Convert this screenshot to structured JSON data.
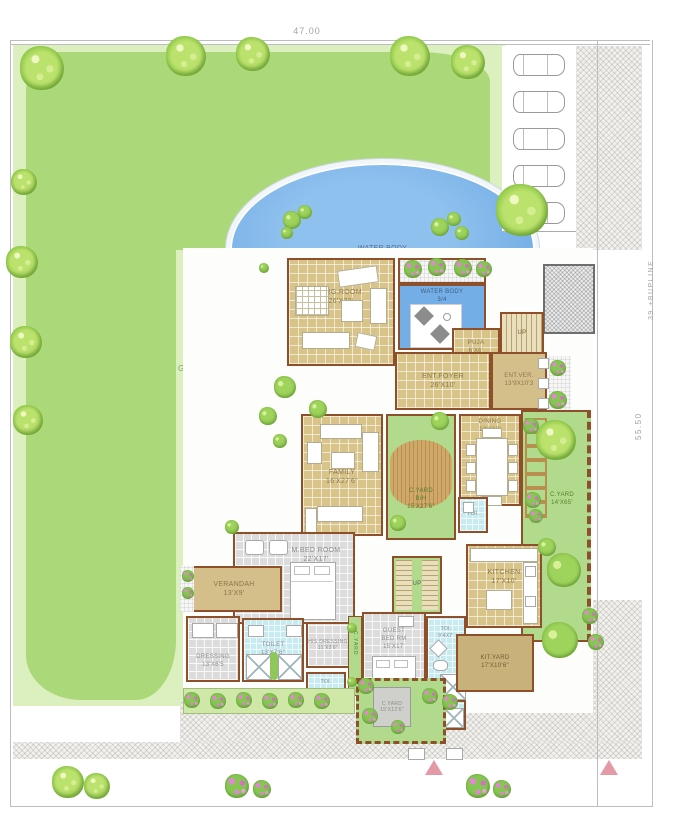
{
  "title": "residential site / floor plan",
  "dimensions": {
    "plot_width": "47.00",
    "build_line": "39 +BUPLINE",
    "plot_depth": "55.50"
  },
  "garden": {
    "label": "GARDEN"
  },
  "pool": {
    "label": "WATER BODY"
  },
  "rooms": {
    "drg_room": {
      "name": "DRG.ROOM",
      "size": "26'X23'"
    },
    "water_body_sm": {
      "name": "WATER BODY",
      "size": "3/4"
    },
    "puja": {
      "name": "PUJA",
      "size": "6'X6'"
    },
    "ent_foyer": {
      "name": "ENT.FOYER",
      "size": "26'X10'"
    },
    "ent_ver": {
      "name": "ENT.VER.",
      "size": "13'9X10'3"
    },
    "family": {
      "name": "FAMILY",
      "size": "16'X27'6\""
    },
    "cyard_bh": {
      "name": "C.YARD",
      "mid": "B/H",
      "size": "15'X27'6\""
    },
    "dining": {
      "name": "DINING",
      "size": "12'X18'"
    },
    "cyard_right": {
      "name": "C.YARD",
      "size": "14'X65'"
    },
    "mbed": {
      "name": "M.BED ROOM",
      "size": "22'X17'"
    },
    "verandah": {
      "name": "VERANDAH",
      "size": "13'X9'"
    },
    "dressing": {
      "name": "DRESSING",
      "size": "13'X6'5"
    },
    "toilet": {
      "name": "TOILET",
      "size": "13'X7'6\""
    },
    "his_dressing": {
      "name": "HIS DRESSING",
      "size": "11'X3'6\""
    },
    "cyard_mid": {
      "name": "C.YARD"
    },
    "guest": {
      "name": "GUEST",
      "name2": "BED RM",
      "size": "15'X17'"
    },
    "guest_toi": {
      "name": "TOI.",
      "size": "9'4X7'"
    },
    "kitchen": {
      "name": "KITCHEN",
      "size": "17'X10'"
    },
    "kit_yard": {
      "name": "KIT.YARD",
      "size": "17'X10'6\""
    },
    "cyard_bottom": {
      "name": "C.YARD",
      "size": "15'X12'6\""
    },
    "toi_a": {
      "name": "TOI."
    },
    "toi_b": {
      "name": "TOI."
    },
    "up_pool": "UP",
    "up_center": "UP"
  },
  "colors": {
    "garden_green": "#abd878",
    "garden_light": "#dcefbe",
    "water_blue": "#74aee6",
    "floor_tan": "#d8c488",
    "wall_brown": "#8e4f2b",
    "toilet_cyan": "#c7ebf1",
    "flower_pink": "#d76fc6",
    "gate_pink": "#e49aa6"
  },
  "landscape": {
    "plants": [
      {
        "kind": "tree",
        "x": 42,
        "y": 68,
        "r": 22
      },
      {
        "kind": "tree",
        "x": 186,
        "y": 56,
        "r": 20
      },
      {
        "kind": "tree",
        "x": 253,
        "y": 54,
        "r": 17
      },
      {
        "kind": "tree",
        "x": 410,
        "y": 56,
        "r": 20
      },
      {
        "kind": "tree",
        "x": 468,
        "y": 62,
        "r": 17
      },
      {
        "kind": "tree",
        "x": 522,
        "y": 210,
        "r": 26
      },
      {
        "kind": "tree",
        "x": 24,
        "y": 182,
        "r": 13
      },
      {
        "kind": "tree",
        "x": 22,
        "y": 262,
        "r": 16
      },
      {
        "kind": "tree",
        "x": 26,
        "y": 342,
        "r": 16
      },
      {
        "kind": "tree",
        "x": 28,
        "y": 420,
        "r": 15
      },
      {
        "kind": "tree",
        "x": 556,
        "y": 440,
        "r": 20
      },
      {
        "kind": "tree",
        "x": 68,
        "y": 782,
        "r": 16
      },
      {
        "kind": "tree",
        "x": 97,
        "y": 786,
        "r": 13
      },
      {
        "kind": "bush",
        "x": 292,
        "y": 220,
        "r": 9
      },
      {
        "kind": "bush",
        "x": 305,
        "y": 212,
        "r": 7
      },
      {
        "kind": "bush",
        "x": 287,
        "y": 233,
        "r": 6
      },
      {
        "kind": "bush",
        "x": 440,
        "y": 227,
        "r": 9
      },
      {
        "kind": "bush",
        "x": 454,
        "y": 219,
        "r": 7
      },
      {
        "kind": "bush",
        "x": 462,
        "y": 233,
        "r": 7
      },
      {
        "kind": "bush",
        "x": 264,
        "y": 268,
        "r": 5
      },
      {
        "kind": "bush",
        "x": 285,
        "y": 387,
        "r": 11
      },
      {
        "kind": "bush",
        "x": 268,
        "y": 416,
        "r": 9
      },
      {
        "kind": "bush",
        "x": 318,
        "y": 409,
        "r": 9
      },
      {
        "kind": "bush",
        "x": 280,
        "y": 441,
        "r": 7
      },
      {
        "kind": "bush",
        "x": 232,
        "y": 527,
        "r": 7
      },
      {
        "kind": "bush",
        "x": 440,
        "y": 421,
        "r": 9
      },
      {
        "kind": "bush",
        "x": 398,
        "y": 523,
        "r": 8
      },
      {
        "kind": "bush",
        "x": 564,
        "y": 570,
        "r": 17
      },
      {
        "kind": "bush",
        "x": 560,
        "y": 640,
        "r": 18
      },
      {
        "kind": "bush",
        "x": 352,
        "y": 628,
        "r": 5
      },
      {
        "kind": "bush",
        "x": 352,
        "y": 682,
        "r": 5
      },
      {
        "kind": "bush",
        "x": 547,
        "y": 547,
        "r": 9
      },
      {
        "kind": "flower",
        "x": 413,
        "y": 269,
        "r": 9
      },
      {
        "kind": "flower",
        "x": 437,
        "y": 267,
        "r": 9
      },
      {
        "kind": "flower",
        "x": 463,
        "y": 268,
        "r": 9
      },
      {
        "kind": "flower",
        "x": 484,
        "y": 269,
        "r": 8
      },
      {
        "kind": "flower",
        "x": 558,
        "y": 368,
        "r": 8
      },
      {
        "kind": "flower",
        "x": 558,
        "y": 400,
        "r": 9
      },
      {
        "kind": "flower",
        "x": 531,
        "y": 426,
        "r": 8
      },
      {
        "kind": "flower",
        "x": 533,
        "y": 500,
        "r": 8
      },
      {
        "kind": "flower",
        "x": 536,
        "y": 516,
        "r": 7
      },
      {
        "kind": "flower",
        "x": 590,
        "y": 616,
        "r": 8
      },
      {
        "kind": "flower",
        "x": 596,
        "y": 642,
        "r": 8
      },
      {
        "kind": "flower",
        "x": 188,
        "y": 576,
        "r": 6
      },
      {
        "kind": "flower",
        "x": 188,
        "y": 593,
        "r": 6
      },
      {
        "kind": "flower",
        "x": 192,
        "y": 700,
        "r": 8
      },
      {
        "kind": "flower",
        "x": 218,
        "y": 701,
        "r": 8
      },
      {
        "kind": "flower",
        "x": 244,
        "y": 700,
        "r": 8
      },
      {
        "kind": "flower",
        "x": 270,
        "y": 701,
        "r": 8
      },
      {
        "kind": "flower",
        "x": 296,
        "y": 700,
        "r": 8
      },
      {
        "kind": "flower",
        "x": 322,
        "y": 701,
        "r": 8
      },
      {
        "kind": "flower",
        "x": 366,
        "y": 686,
        "r": 8
      },
      {
        "kind": "flower",
        "x": 430,
        "y": 696,
        "r": 8
      },
      {
        "kind": "flower",
        "x": 450,
        "y": 702,
        "r": 8
      },
      {
        "kind": "flower",
        "x": 370,
        "y": 716,
        "r": 8
      },
      {
        "kind": "flower",
        "x": 398,
        "y": 727,
        "r": 7
      },
      {
        "kind": "flower",
        "x": 237,
        "y": 786,
        "r": 12
      },
      {
        "kind": "flower",
        "x": 262,
        "y": 789,
        "r": 9
      },
      {
        "kind": "flower",
        "x": 478,
        "y": 786,
        "r": 12
      },
      {
        "kind": "flower",
        "x": 502,
        "y": 789,
        "r": 9
      }
    ]
  }
}
